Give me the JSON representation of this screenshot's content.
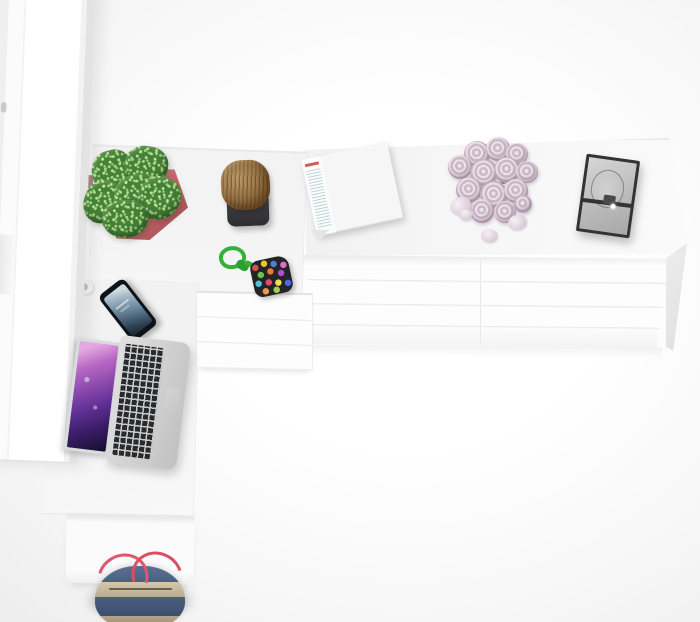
{
  "image": {
    "type": "3d-render-top-view",
    "subject": "White home office furniture set viewed from directly above: tall cabinet, corner desk and wide chest of drawers with decor props",
    "canvas": {
      "width": 700,
      "height": 622
    }
  },
  "palette": {
    "background": "#f7f7f7",
    "furniture-white": "#fcfcfc",
    "edge-grey": "#e3e3e3",
    "pot-pink": "#c4666a",
    "plant-green": "#44803a",
    "stool-wood": "#8f6a3c",
    "stool-base": "#2d2d31",
    "cord-green": "#35b13a",
    "pouch-dark": "#232328",
    "phone-black": "#101218",
    "phone-screen-blue": "#5f7b90",
    "laptop-silver": "#d2d2d2",
    "laptop-screen-purple": "#8b49ad",
    "key-black": "#292a2e",
    "magazine-red": "#c24330",
    "magazine-sky": "#b5c3c8",
    "rose-pink": "#cbb8c8",
    "frame-dark": "#333333",
    "frame-glass": "#bcbcbc",
    "bag-denim": "#4a5e80",
    "bag-canvas": "#b7a894",
    "bag-strap-red": "#e0566a"
  },
  "furniture": {
    "wardrobe": {
      "label": "tall white cabinet (left edge)",
      "hinge_count": 2
    },
    "desk": {
      "label": "white corner desk",
      "pedestal_drawers": 3
    },
    "dresser": {
      "label": "wide white chest of drawers",
      "drawer_columns": 2,
      "drawer_rows": 4
    }
  },
  "props": [
    {
      "name": "potted-plant",
      "pot_color": "#c4666a",
      "leaf_color": "#44803a"
    },
    {
      "name": "wooden-stool",
      "seat": "wood grain",
      "base_color": "#2d2d31"
    },
    {
      "name": "pompom-pouch",
      "cord_color": "#35b13a",
      "body": "multicolor dots on dark felt"
    },
    {
      "name": "smartphone",
      "body_color": "#101218",
      "screen": "blue lock screen"
    },
    {
      "name": "laptop",
      "finish": "silver, black keys",
      "wallpaper": "purple galaxy"
    },
    {
      "name": "magazine",
      "state": "open",
      "left_page": "photo of red building with trees",
      "right_page": "text column with red heading"
    },
    {
      "name": "rose-bouquet",
      "rose_count": 13,
      "loose_petals": 4,
      "color": "pale pink"
    },
    {
      "name": "picture-frame",
      "frame_color": "#333333",
      "glass": "grey reflective"
    },
    {
      "name": "tote-bag",
      "body": "denim",
      "trim": "canvas",
      "strap_color": "#e0566a"
    }
  ]
}
